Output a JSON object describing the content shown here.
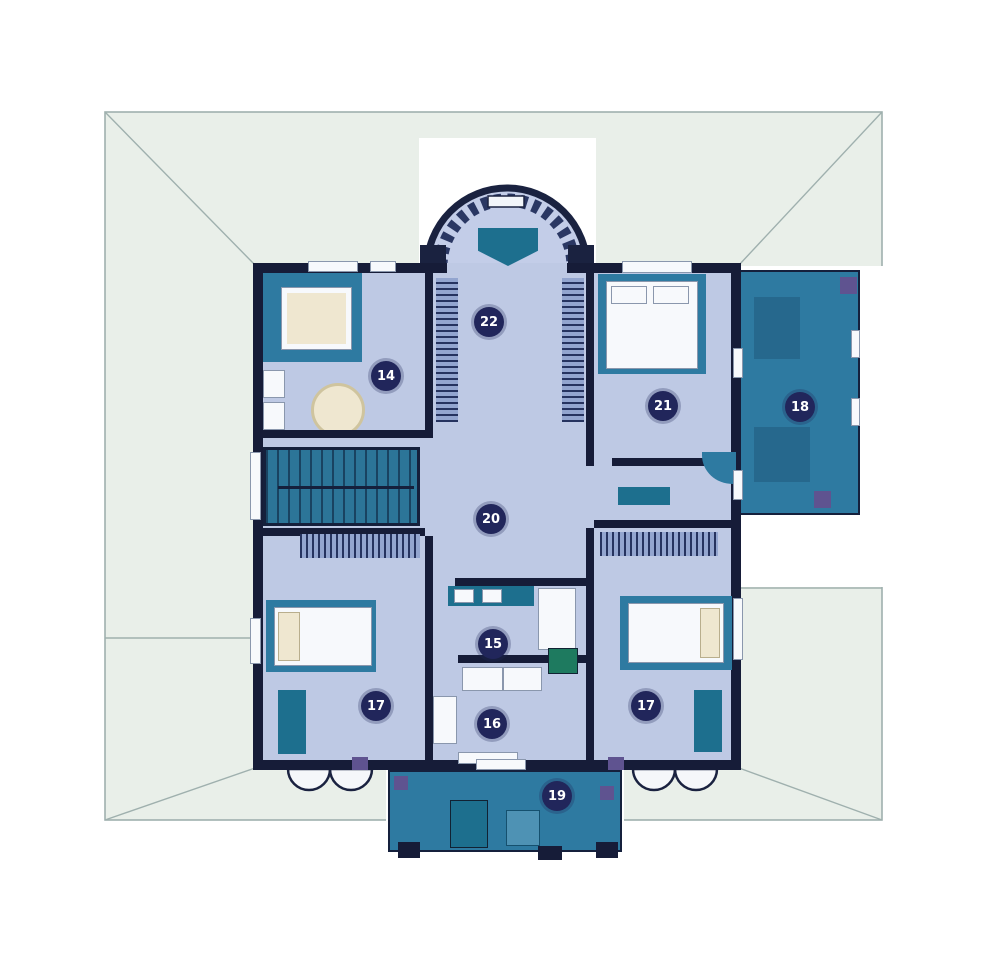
{
  "plan": {
    "type": "architectural-floor-plan",
    "floor_label": "upper floor"
  },
  "colors": {
    "background": "#ffffff",
    "roof_fill": "#e9efe9",
    "roof_line": "#9fb0ae",
    "wall": "#161c38",
    "floor": "#bec9e4",
    "teal_accent": "#2e7aa1",
    "teal_furniture": "#1d6f8e",
    "badge_bg": "#21265b",
    "badge_text": "#ffffff",
    "cream_fixture": "#efe7d0",
    "purple_post": "#5f5390",
    "green_fixture": "#1e7a5f"
  },
  "rooms": [
    {
      "key": "room-14-dressing",
      "number": "14"
    },
    {
      "key": "room-15-bath-upper",
      "number": "15"
    },
    {
      "key": "room-16-bath-lower",
      "number": "16"
    },
    {
      "key": "bedroom-bottom-left",
      "number": "17"
    },
    {
      "key": "bedroom-bottom-right",
      "number": "17"
    },
    {
      "key": "terrace-right",
      "number": "18"
    },
    {
      "key": "balcony-bottom",
      "number": "19"
    },
    {
      "key": "hall-center",
      "number": "20"
    },
    {
      "key": "bedroom-top-right",
      "number": "21"
    },
    {
      "key": "bay-room-top",
      "number": "22"
    }
  ]
}
